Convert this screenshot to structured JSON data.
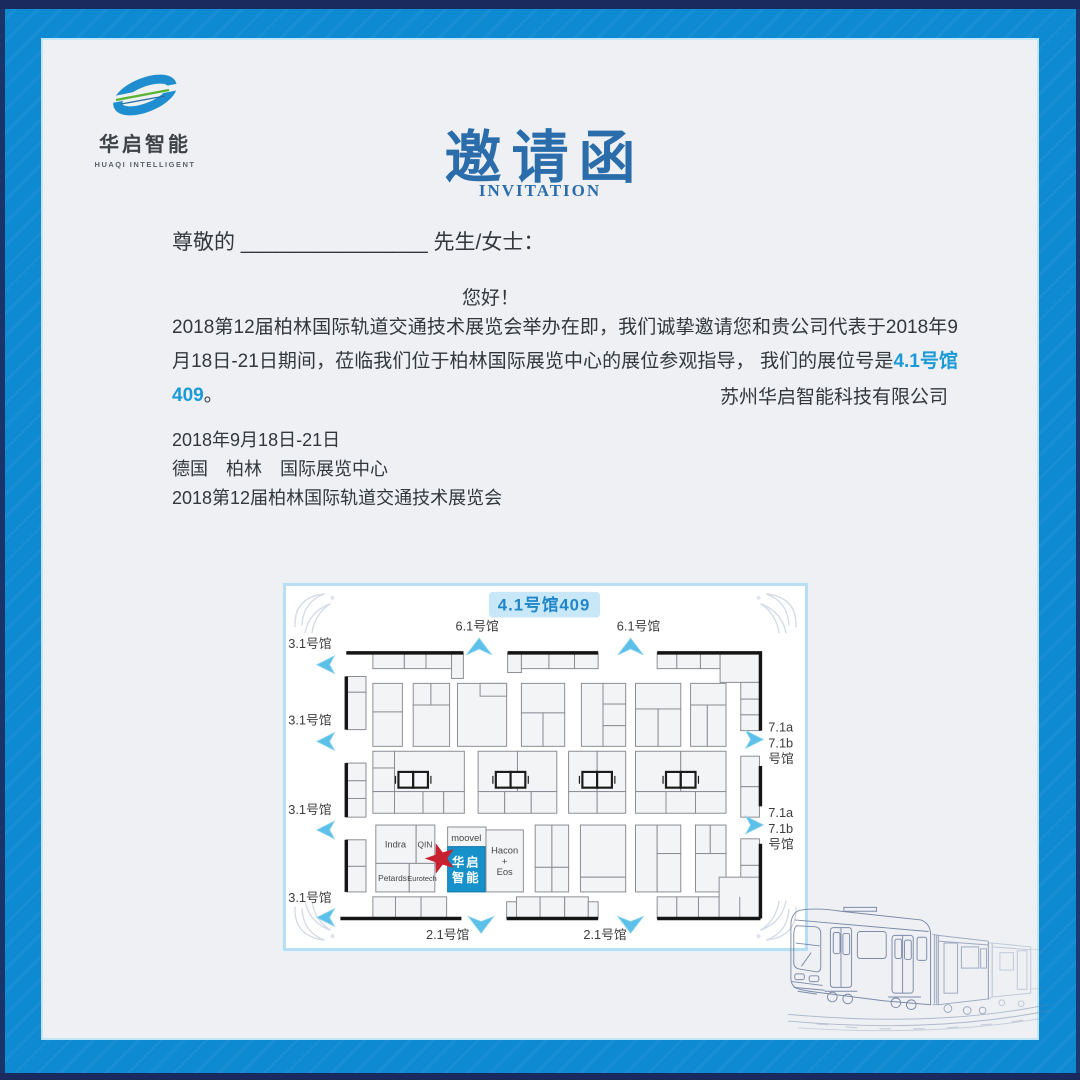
{
  "logo": {
    "name_cn": "华启智能",
    "name_en": "HUAQI INTELLIGENT"
  },
  "header": {
    "title_cn": "邀请函",
    "title_en": "INVITATION"
  },
  "letter": {
    "salutation_prefix": "尊敬的 ",
    "salutation_blank": "________________",
    "salutation_suffix": " 先生/女士：",
    "greeting": "您好！",
    "body_text_1": "2018第12届柏林国际轨道交通技术展览会举办在即，我们诚挚邀请您和贵公司代表于2018年9月18日-21日期间，莅临我们位于柏林国际展览中心的展位参观指导， 我们的展位号是",
    "body_highlight": "4.1号馆409",
    "body_text_2": "。",
    "signature": "苏州华启智能科技有限公司",
    "info_lines": [
      "2018年9月18日-21日",
      "德国　柏林　国际展览中心",
      "2018第12届柏林国际轨道交通技术展览会"
    ]
  },
  "floorplan": {
    "badge": "4.1号馆409",
    "hall_top": "6.1号馆",
    "hall_left": "3.1号馆",
    "hall_right_line1": "7.1a",
    "hall_right_line2": "7.1b",
    "hall_right_line3": "号馆",
    "hall_bottom": "2.1号馆",
    "exhibitors": {
      "indra": "Indra",
      "qin": "QIN",
      "petards": "Petards",
      "eurotech": "Eurotech",
      "moovel": "moovel",
      "hacon_line1": "Hacon",
      "hacon_line2": "+",
      "hacon_line3": "Eos",
      "booth_line1": "华启",
      "booth_line2": "智能"
    },
    "colors": {
      "booth_highlight": "#1791ca",
      "star_red": "#c8202e",
      "arrow_blue": "#5cc0e8",
      "badge_bg": "#c8e7f8",
      "badge_text": "#1f86c9"
    }
  },
  "colors": {
    "frame_blue": "#0e8ad3",
    "frame_edge": "#1b2a5e",
    "card_bg": "#eef0f4",
    "title_blue": "#2b6dab",
    "highlight_blue": "#1b9ad8",
    "body_text": "#33373b"
  }
}
